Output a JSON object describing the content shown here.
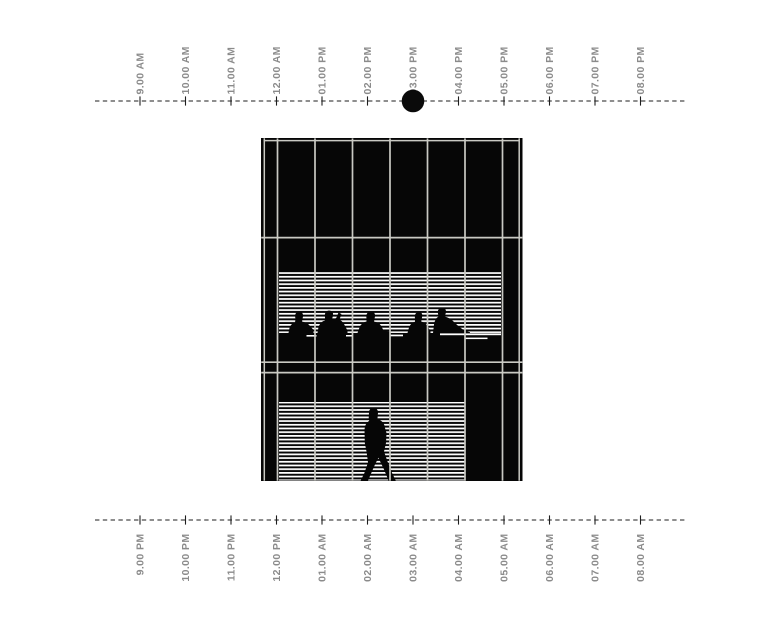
{
  "scene": {
    "title": "building day-night occupancy timeline",
    "colors": {
      "background": "#ffffff",
      "ink": "#0a0a0a",
      "building_black": "#060606",
      "grid_gray": "#c9c9c3",
      "label_gray": "#8b8b8b",
      "blinds_white": "#ffffff"
    }
  },
  "top_axis": {
    "name": "daytime",
    "labels": [
      "9.00 AM",
      "10.00 AM",
      "11.00 AM",
      "12.00 AM",
      "01.00 PM",
      "02.00 PM",
      "03.00 PM",
      "04.00 PM",
      "05.00 PM",
      "06.00 PM",
      "07.00 PM",
      "08.00 PM"
    ],
    "marker_label": "03.00 PM",
    "marker_index": 6
  },
  "bottom_axis": {
    "name": "nighttime",
    "labels": [
      "9.00 PM",
      "10.00 PM",
      "11.00 PM",
      "12.00 PM",
      "01.00 AM",
      "02.00 AM",
      "03.00 AM",
      "04.00 AM",
      "05.00 AM",
      "06.00 AM",
      "07.00 AM",
      "08.00 AM"
    ]
  },
  "building": {
    "floors": 3,
    "window_columns": 8,
    "middle_floor": {
      "blinds": true,
      "occupants": "five seated office workers"
    },
    "ground_floor": {
      "blinds": true,
      "occupants": "one walking person"
    }
  }
}
